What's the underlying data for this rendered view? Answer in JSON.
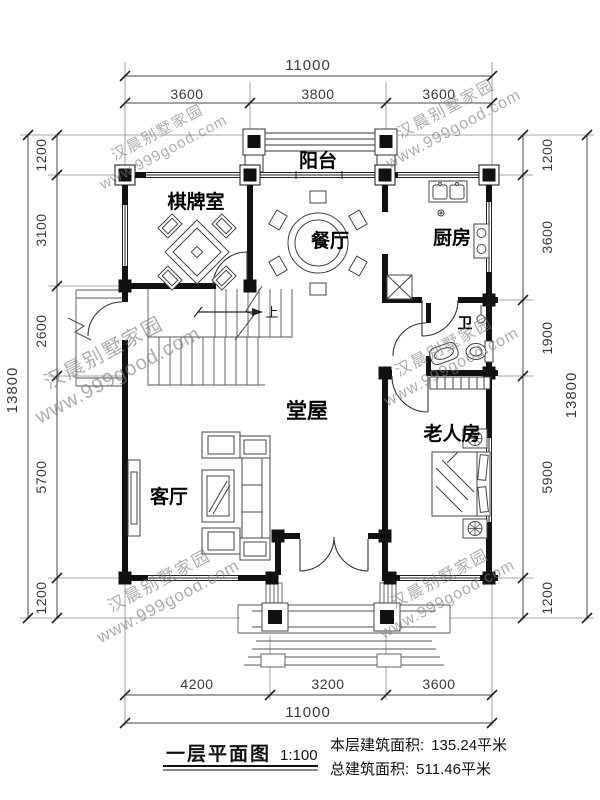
{
  "title": {
    "name": "一层平面图",
    "scale": "1:100"
  },
  "areas": {
    "floor_label": "本层建筑面积:",
    "floor_value": "135.24平米",
    "total_label": "总建筑面积:",
    "total_value": "511.46平米"
  },
  "rooms": {
    "balcony": "阳台",
    "chess_room": "棋牌室",
    "dining": "餐厅",
    "kitchen": "厨房",
    "bath": "卫",
    "hall": "堂屋",
    "living": "客厅",
    "elder_room": "老人房",
    "stairs_up": "上"
  },
  "dimensions": {
    "top": {
      "total": "11000",
      "segments": [
        "3600",
        "3800",
        "3600"
      ]
    },
    "bottom": {
      "total": "11000",
      "segments": [
        "4200",
        "3200",
        "3600"
      ]
    },
    "left": {
      "total": "13800",
      "segments": [
        "1200",
        "3100",
        "2600",
        "5700",
        "1200"
      ]
    },
    "right": {
      "total": "13800",
      "segments": [
        "1200",
        "3600",
        "1900",
        "5900",
        "1200"
      ]
    }
  },
  "watermark": {
    "line1": "汉晨别墅家园",
    "line2": "www.999good.com"
  },
  "colors": {
    "wall": "#111111",
    "thin_line": "#444444",
    "dim_line": "#555555",
    "dim_text": "#3a3a3a",
    "watermark": "#7a7a7a",
    "background": "#ffffff"
  }
}
